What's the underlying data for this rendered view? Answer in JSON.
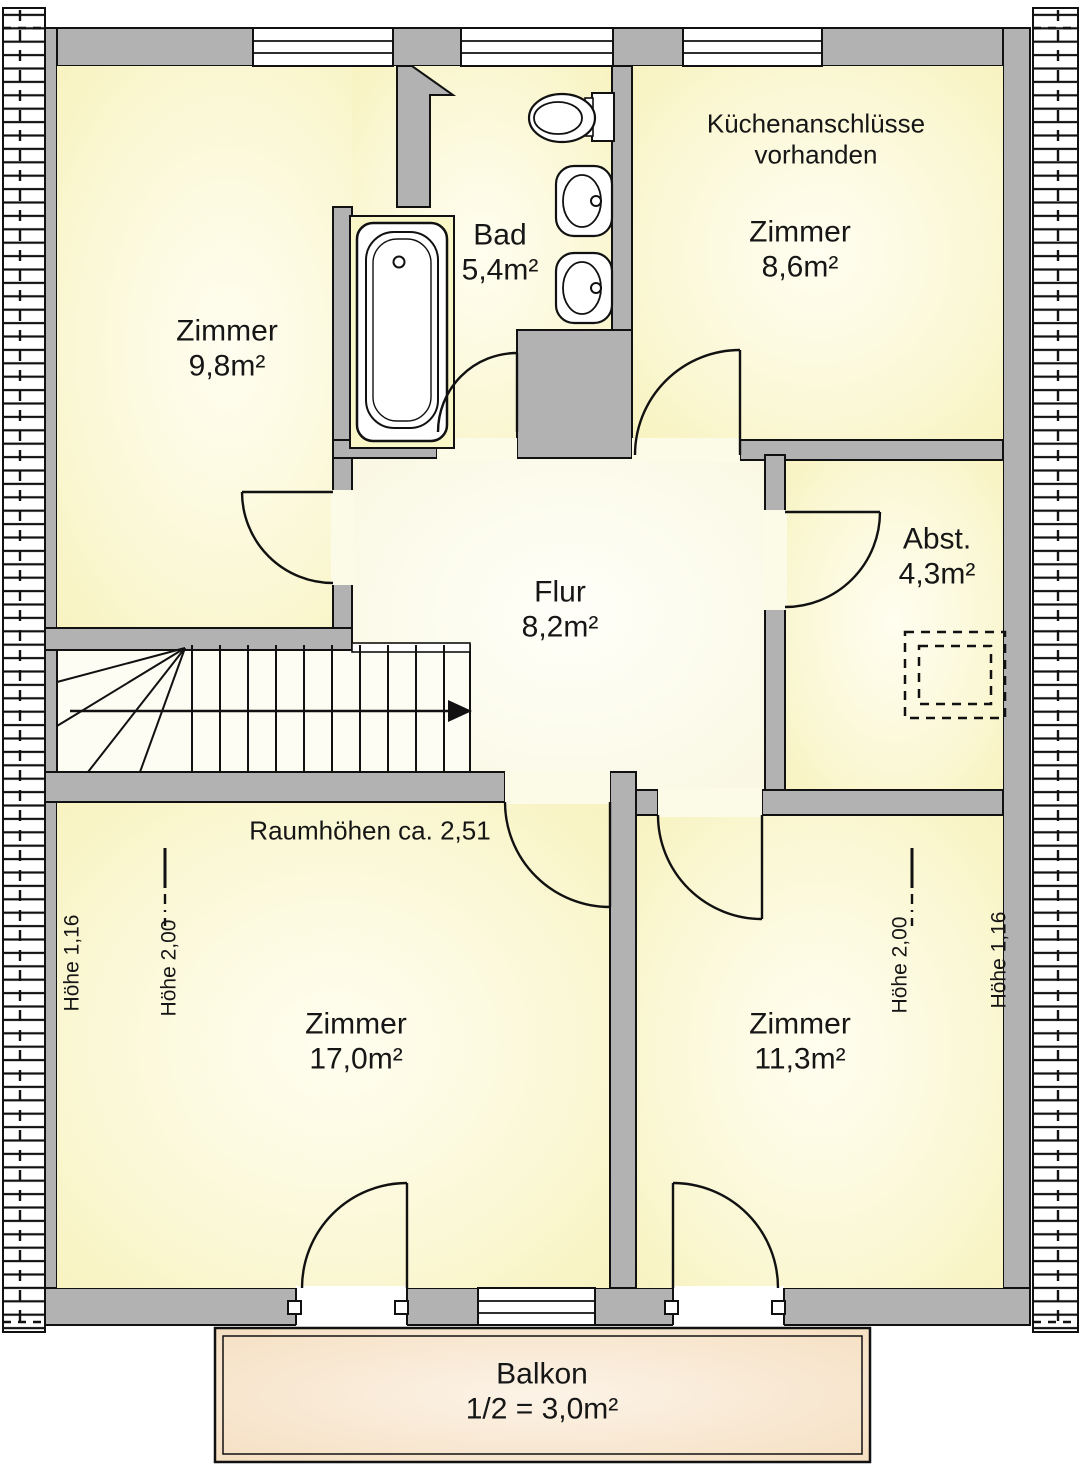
{
  "floorplan": {
    "rooms": [
      {
        "name": "Zimmer",
        "area": "9,8m²"
      },
      {
        "name": "Bad",
        "area": "5,4m²"
      },
      {
        "name": "Zimmer",
        "area": "8,6m²"
      },
      {
        "name": "Flur",
        "area": "8,2m²"
      },
      {
        "name": "Abst.",
        "area": "4,3m²"
      },
      {
        "name": "Zimmer",
        "area": "17,0m²"
      },
      {
        "name": "Zimmer",
        "area": "11,3m²"
      },
      {
        "name": "Balkon",
        "area": "1/2 = 3,0m²"
      }
    ],
    "notes": {
      "kitchen_line1": "Küchenanschlüsse",
      "kitchen_line2": "vorhanden",
      "ceiling_height": "Raumhöhen ca. 2,51"
    },
    "height_marks": {
      "left_wall": "Höhe 1,16",
      "left_knee": "Höhe 2,00",
      "right_knee": "Höhe 2,00",
      "right_wall": "Höhe 1,16"
    },
    "colors": {
      "wall": "#B2B2B2",
      "room_fill": "#FAF7C8",
      "hall_fill": "#FCFBEA",
      "balcony_fill": "#F7E2C6",
      "outline": "#111111"
    }
  }
}
